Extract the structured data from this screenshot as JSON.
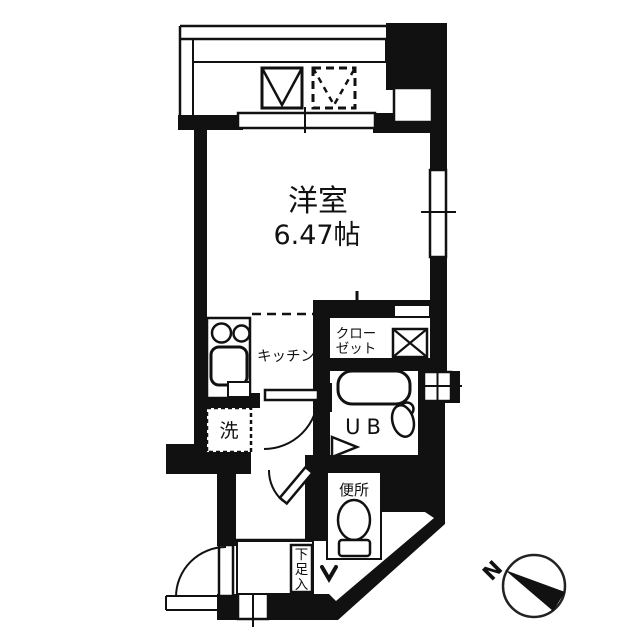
{
  "floorplan": {
    "main_room": {
      "name": "洋室",
      "size": "6.47帖"
    },
    "kitchen_label": "キッチン",
    "closet_label_line1": "クロー",
    "closet_label_line2": "ゼット",
    "washer_label": "洗",
    "unit_bath_label": "UB",
    "toilet_label": "便所",
    "shoe_box_chars": [
      "下",
      "足",
      "入"
    ],
    "compass_north": "N",
    "colors": {
      "wall": "#111111",
      "background": "#ffffff"
    }
  }
}
